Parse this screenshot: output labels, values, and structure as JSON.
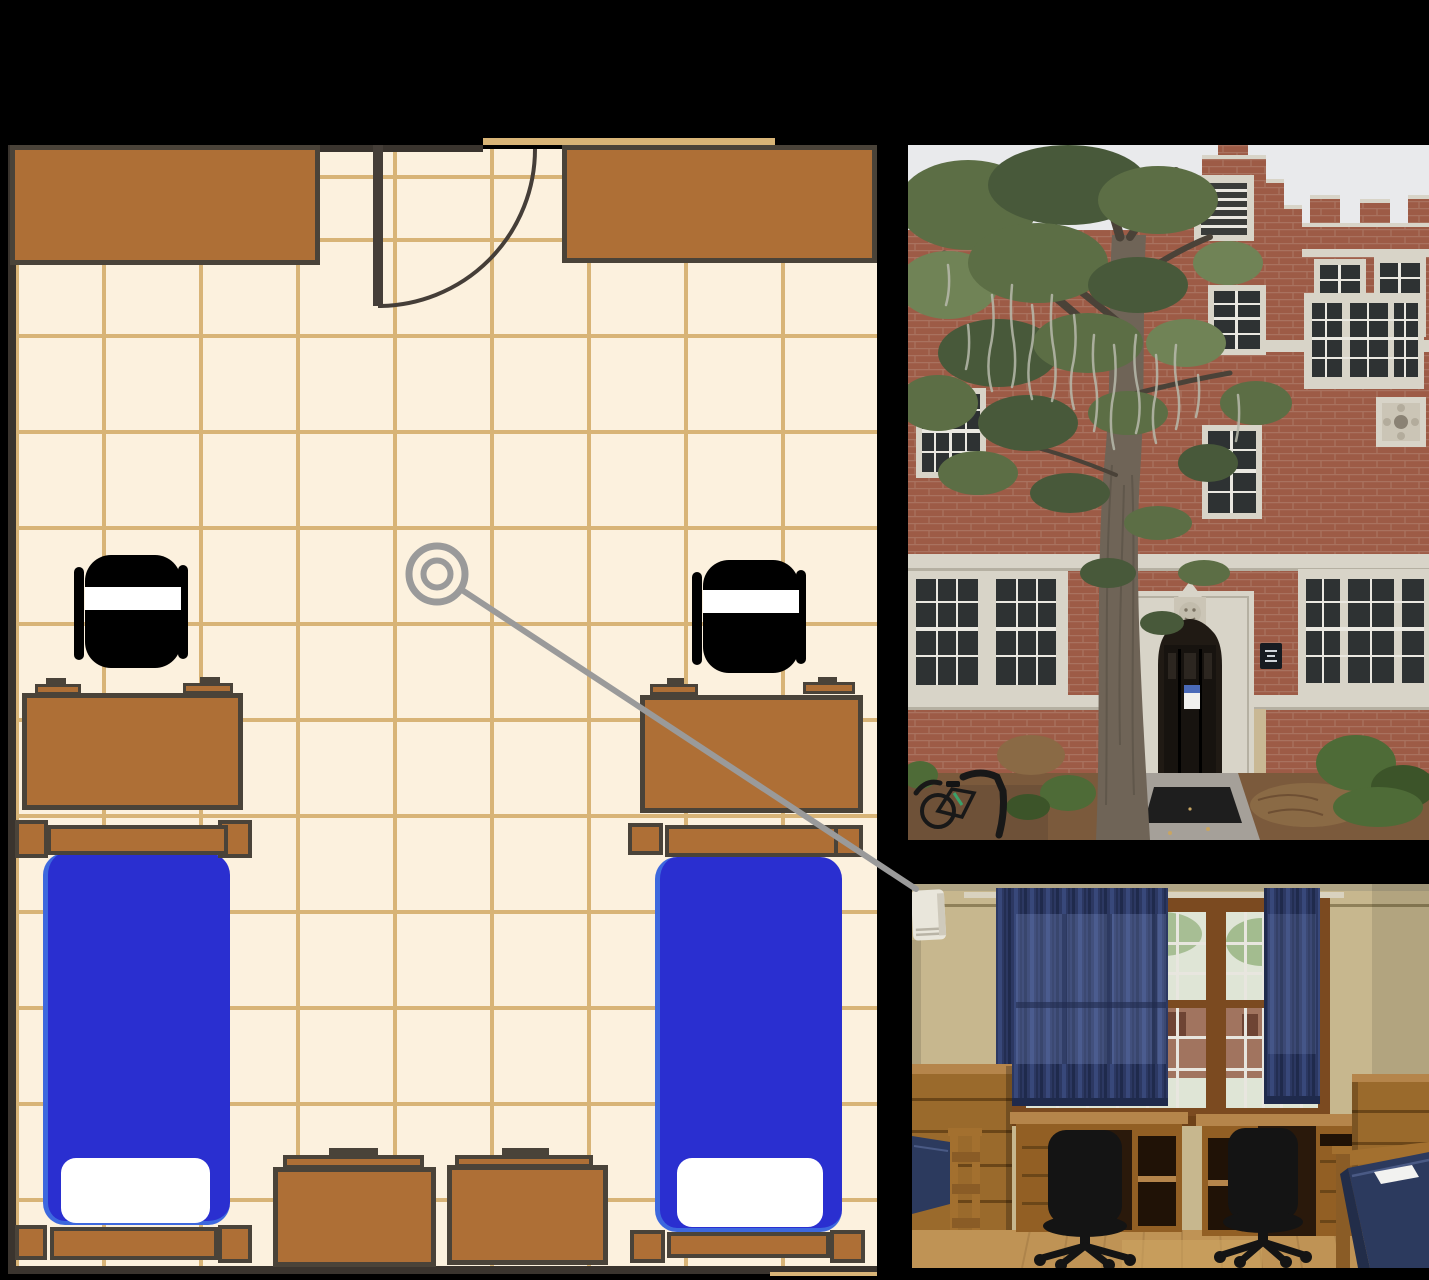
{
  "scene": {
    "background": "#000000",
    "description": "Dorm room floor plan connected by a camera callout line to two photos: dorm building exterior and dorm room interior"
  },
  "floorplan": {
    "label": "dorm-room-floor-plan",
    "furniture": [
      "closet-left",
      "closet-right",
      "entry-door",
      "desk-left",
      "desk-right",
      "chair-left",
      "chair-right",
      "bed-left",
      "bed-right",
      "dresser-left",
      "dresser-right"
    ],
    "camera_marker": {
      "cx": 437,
      "cy": 574
    },
    "palette": {
      "floor": "#fcf1de",
      "grid": "#d8b477",
      "wall": "#3a342e",
      "furniture": "#ae6f36",
      "outline": "#4a4339",
      "mattress": "#2a2fd0",
      "mattress-edge": "#3d68de",
      "pillow": "#ffffff",
      "chair": "#000000",
      "door": "#453e38",
      "marker": "#9a9a9a"
    }
  },
  "callout": {
    "color": "#9a9a9a",
    "from": {
      "x": 462,
      "y": 590
    },
    "to": {
      "x": 916,
      "y": 889
    }
  },
  "photos": {
    "building": {
      "label": "dorm-building-exterior-photo",
      "description": "Red brick collegiate gothic dormitory entrance with stone trim, arched doorway, crenellated parapet and a large moss-draped tree",
      "palette": {
        "sky": "#e9eaec",
        "brick": "#9d5b46",
        "mortar": "#b98f7e",
        "stone": "#d8d4c8",
        "stone-shadow": "#b5b0a2",
        "window": "#2e3233",
        "muntin": "#eae8e1",
        "foliage": "#5c6e45",
        "foliage-dark": "#48593a",
        "foliage-light": "#708356",
        "moss": "#b7baac",
        "trunk": "#6f6457",
        "bark": "#5a5146",
        "branch": "#4a4238",
        "ground": "#7b5a3c",
        "straw": "#8a6a45",
        "bush": "#4e6b37",
        "bush-dark": "#3c5429",
        "walk": "#a5a099",
        "mat": "#1e1e1e",
        "door": "#17130f",
        "stucco": "#c9b894",
        "flyer-blue": "#4a6ab8",
        "plaque": "#171b21",
        "bike": "#181818",
        "bike-accent": "#3aa06a"
      }
    },
    "interior": {
      "label": "dorm-room-interior-photo",
      "description": "Dorm room interior with navy curtains, double window, two wooden desks with black office chairs, dressers and two beds with navy mattresses",
      "palette": {
        "wall": "#c7b78e",
        "wall-shadow": "#9a8a64",
        "ceiling": "#b0a585",
        "rail": "#8f8059",
        "rod": "#d9d2bf",
        "ac": "#e9e6db",
        "wood": "#7b4a20",
        "wood-dark": "#6e4118",
        "glass": "#dfe5d6",
        "glass-green": "#8fae77",
        "glass-brick": "#96604a",
        "curtain": "#2c3862",
        "curtain-dark": "#1f2a4c",
        "curtain-light": "#3b4c80",
        "curtain-glow": "#7f90c4",
        "desk-top": "#b5854b",
        "desk-front": "#925f24",
        "drawer-line": "#6b4618",
        "kneehole": "#2a190b",
        "cubby": "#201206",
        "chair": "#141414",
        "dresser": "#9a6a2c",
        "mattress": "#2c3a5e",
        "mattress-dark": "#222d49",
        "paper": "#f2f2f0",
        "floor": "#bf9355",
        "floor-line": "#a87f47",
        "post": "#a3702f",
        "post-dark": "#8a5c26"
      }
    }
  }
}
